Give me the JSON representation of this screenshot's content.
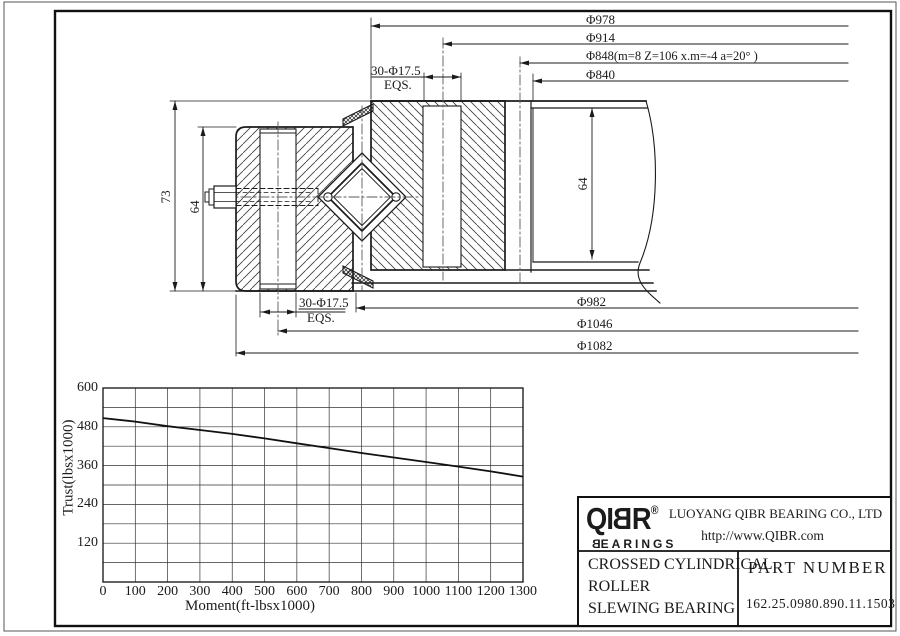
{
  "drawing": {
    "top_dims": [
      "Φ978",
      "Φ914",
      "Φ848(m=8 Z=106 x.m=-4 a=20° )",
      "Φ840"
    ],
    "bottom_dims": [
      "Φ982",
      "Φ1046",
      "Φ1082"
    ],
    "hole_callout_top": {
      "line1": "30-Φ17.5",
      "line2": "EQS."
    },
    "hole_callout_bottom": {
      "line1": "30-Φ17.5",
      "line2": "EQS."
    },
    "height_overall": "73",
    "height_inner": "64",
    "height_right": "64"
  },
  "chart_data": {
    "type": "line",
    "xlabel": "Moment(ft-lbsx1000)",
    "ylabel": "Trust(lbsx1000)",
    "x": [
      0,
      100,
      200,
      300,
      400,
      500,
      600,
      700,
      800,
      900,
      1000,
      1100,
      1200,
      1300
    ],
    "series": [
      {
        "name": "static capacity curve",
        "values": [
          507,
          496,
          482,
          470,
          458,
          444,
          429,
          414,
          399,
          385,
          371,
          357,
          342,
          326
        ]
      }
    ],
    "xlim": [
      0,
      1300
    ],
    "ylim": [
      0,
      600
    ],
    "x_ticks": [
      0,
      100,
      200,
      300,
      400,
      500,
      600,
      700,
      800,
      900,
      1000,
      1100,
      1200,
      1300
    ],
    "y_ticks": [
      120,
      240,
      360,
      480,
      600
    ],
    "grid": {
      "x_step": 100,
      "y_step": 60
    },
    "legend": "none",
    "line_color": "#111111"
  },
  "title_block": {
    "logo": {
      "prefix": "QI",
      "mirrored_b": "B",
      "suffix": "R",
      "reg": "®",
      "sub_mirrored_b": "B",
      "sub_rest": "EARINGS"
    },
    "company": "LUOYANG QIBR BEARING CO., LTD",
    "website": "http://www.QIBR.com",
    "product_lines": "CROSSED CYLINDRICAL\nROLLER\nSLEWING BEARING",
    "part_number_label": "PART NUMBER",
    "part_number": "162.25.0980.890.11.1503"
  }
}
